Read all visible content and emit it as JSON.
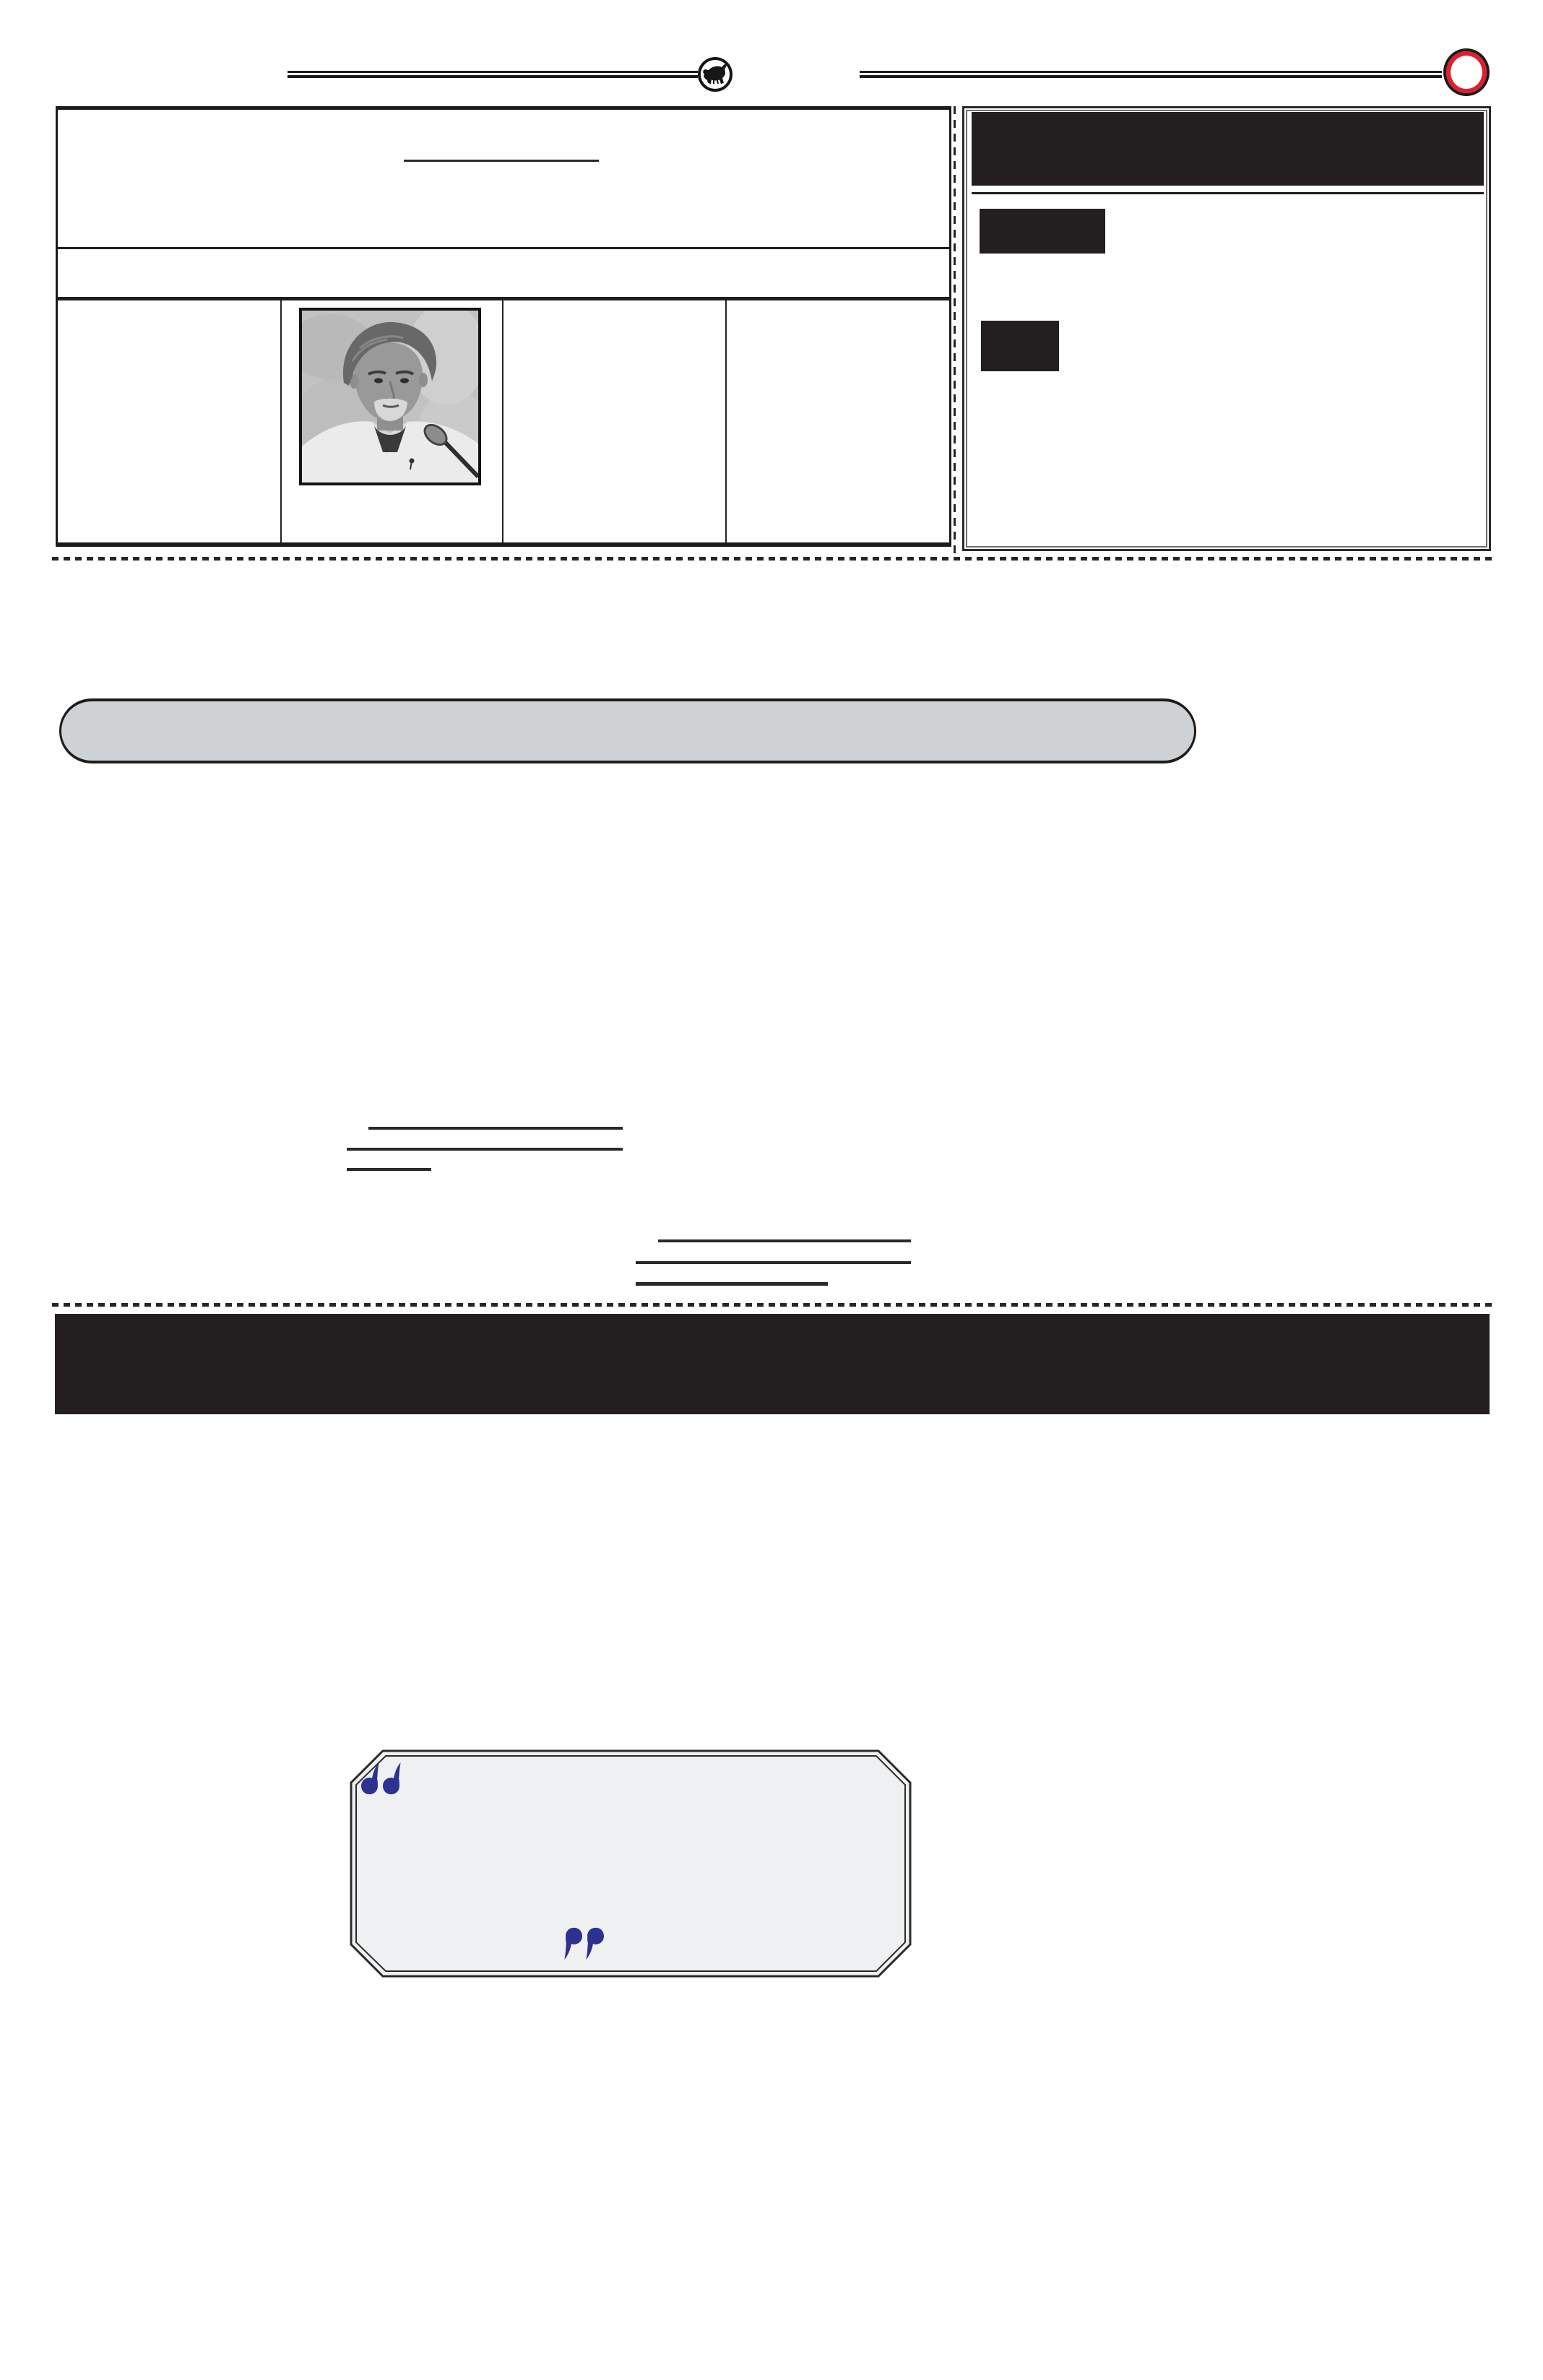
{
  "colors": {
    "ink": "#1f1f1f",
    "rule_black": "#1b1b1b",
    "panel_black": "#231f20",
    "pill_fill": "#cfd2d5",
    "pill_border": "#1c1c1c",
    "quote_fill": "#eef0f1",
    "quote_border": "#2b2b2b",
    "quote_mark_blue": "#2d3190",
    "badge_red": "#e21d2e",
    "badge_ring_black": "#1c1c1c",
    "dash_color": "#262626",
    "underline_color": "#2a2a2a"
  },
  "icons": {
    "bull_emblem": "bull-emblem-icon",
    "page_badge": "red-ring-badge-icon",
    "open_quote": "open-quote-icon",
    "close_quote": "close-quote-icon"
  },
  "quote_panel": {
    "open_glyph": "“",
    "close_glyph": "”"
  },
  "portrait": {
    "subject": "grayscale press photo: gray-haired man in white shirt at microphone"
  },
  "sidebar": {
    "redactions": [
      "header-bar",
      "label-block-1",
      "label-block-2"
    ]
  }
}
